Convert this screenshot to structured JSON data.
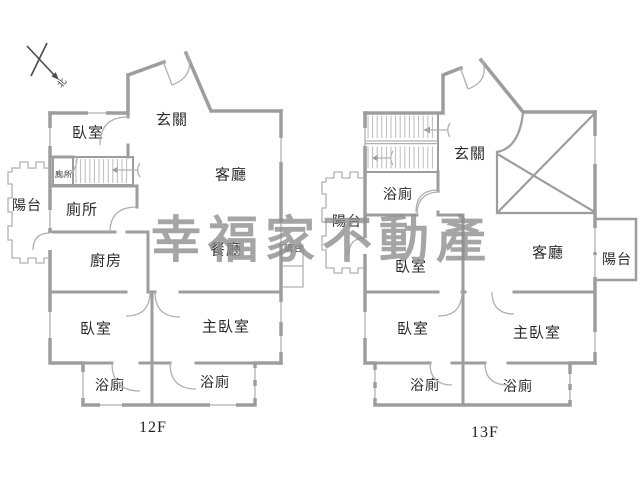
{
  "watermark": {
    "text": "幸福家不動產",
    "color": "#8d8d8d"
  },
  "compass": {
    "north_label": "北"
  },
  "plans": [
    {
      "name": "12f",
      "caption": "12F",
      "rooms": [
        {
          "name": "bedroom-upper",
          "label": "臥室",
          "x": 88,
          "y": 134,
          "size": 15
        },
        {
          "name": "entry-hall",
          "label": "玄關",
          "x": 172,
          "y": 121,
          "size": 15
        },
        {
          "name": "living-room",
          "label": "客廳",
          "x": 231,
          "y": 176,
          "size": 15
        },
        {
          "name": "toilet-closet",
          "label": "廁所",
          "x": 64,
          "y": 175,
          "size": 8
        },
        {
          "name": "toilet",
          "label": "廁所",
          "x": 82,
          "y": 211,
          "size": 15
        },
        {
          "name": "balcony-left",
          "label": "陽台",
          "x": 27,
          "y": 207,
          "size": 14
        },
        {
          "name": "kitchen",
          "label": "廚房",
          "x": 106,
          "y": 262,
          "size": 15
        },
        {
          "name": "dining-room",
          "label": "餐廳",
          "x": 226,
          "y": 251,
          "size": 15
        },
        {
          "name": "balcony-right",
          "label": "陽台",
          "x": 294,
          "y": 249,
          "size": 9
        },
        {
          "name": "bedroom-lower",
          "label": "臥室",
          "x": 96,
          "y": 330,
          "size": 15
        },
        {
          "name": "master-bedroom",
          "label": "主臥室",
          "x": 226,
          "y": 328,
          "size": 15
        },
        {
          "name": "bathroom-left",
          "label": "浴廁",
          "x": 110,
          "y": 387,
          "size": 14
        },
        {
          "name": "bathroom-right",
          "label": "浴廁",
          "x": 215,
          "y": 384,
          "size": 14
        }
      ]
    },
    {
      "name": "13f",
      "caption": "13F",
      "rooms": [
        {
          "name": "entry-hall",
          "label": "玄關",
          "x": 470,
          "y": 155,
          "size": 15
        },
        {
          "name": "bathroom-upper",
          "label": "浴廁",
          "x": 398,
          "y": 196,
          "size": 14
        },
        {
          "name": "balcony-left",
          "label": "陽台",
          "x": 347,
          "y": 223,
          "size": 14
        },
        {
          "name": "bedroom-upper",
          "label": "臥室",
          "x": 411,
          "y": 268,
          "size": 15
        },
        {
          "name": "living-room",
          "label": "客廳",
          "x": 548,
          "y": 254,
          "size": 15
        },
        {
          "name": "balcony-right",
          "label": "陽台",
          "x": 617,
          "y": 261,
          "size": 14
        },
        {
          "name": "bedroom-lower",
          "label": "臥室",
          "x": 413,
          "y": 330,
          "size": 15
        },
        {
          "name": "master-bedroom",
          "label": "主臥室",
          "x": 537,
          "y": 334,
          "size": 15
        },
        {
          "name": "bathroom-left",
          "label": "浴廁",
          "x": 425,
          "y": 387,
          "size": 14
        },
        {
          "name": "bathroom-right",
          "label": "浴廁",
          "x": 518,
          "y": 388,
          "size": 14
        }
      ]
    }
  ]
}
